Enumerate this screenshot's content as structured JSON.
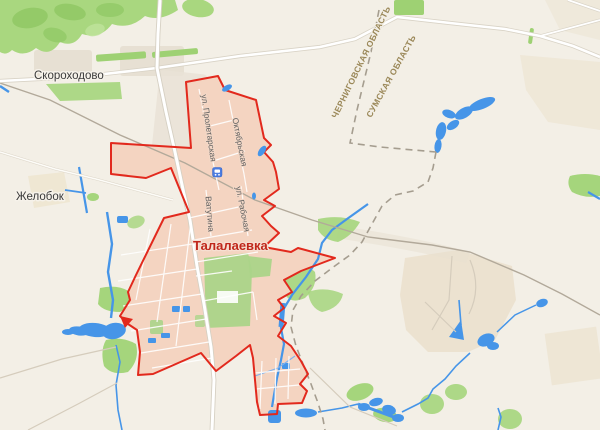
{
  "map": {
    "towns": {
      "skorokhodovo": "Скороходово",
      "zhelobok": "Желобок"
    },
    "settlement": {
      "name": "Талалаевка"
    },
    "streets": {
      "proletarskaya": "ул. Пролетарская",
      "oktyabrskaya": "Октябрьская",
      "rabochaya": "ул. Рабочая",
      "vatutina": "Ватутина"
    },
    "regions": {
      "chernihiv": "ЧЕРНИГОВСКАЯ ОБЛАСТЬ",
      "sumy": "СУМСКАЯ ОБЛАСТЬ"
    },
    "markers": {
      "station": "train-station"
    },
    "colors": {
      "background": "#f3efe6",
      "boundary_red": "#e2291d",
      "settlement_fill": "#f4d4c1",
      "water": "#4695e8",
      "forest": "#a9d77f",
      "oblast_dash": "#a59d8f",
      "railway": "#b2a99a",
      "road_casing": "#d9d3c6",
      "town_label": "#3a3a3a",
      "settlement_label": "#c0271b",
      "region_label": "#9a8757",
      "street_label": "#5f5f5f",
      "station_marker_blue": "#4b7ce0"
    }
  }
}
